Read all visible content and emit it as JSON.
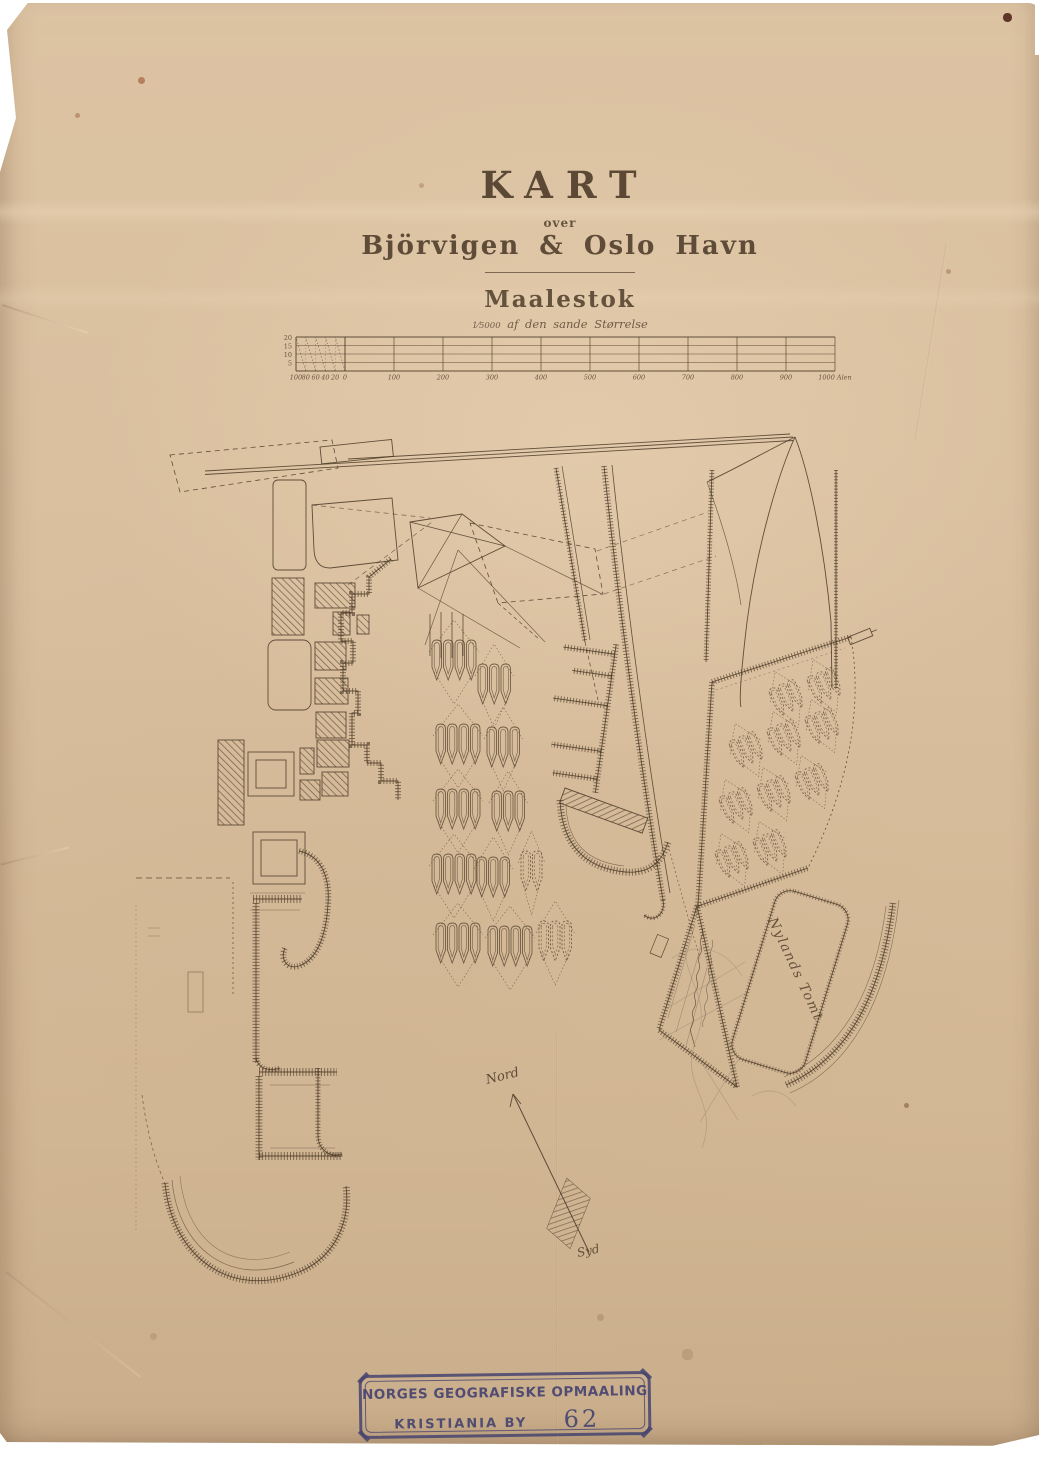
{
  "sheet": {
    "title": "KART",
    "title_sub": "over",
    "title_place": "Björvigen & Oslo Havn"
  },
  "scale": {
    "heading": "Maalestok",
    "fraction": "1⁄5000",
    "subtitle": "af den sande Størrelse",
    "unit": "Alen",
    "row_labels": [
      "20",
      "15",
      "10",
      "5"
    ],
    "left_tick_labels": [
      "100",
      "80",
      "60",
      "40",
      "20"
    ],
    "main_tick_labels": [
      "0",
      "100",
      "200",
      "300",
      "400",
      "500",
      "600",
      "700",
      "800",
      "900",
      "1000"
    ]
  },
  "map": {
    "compass_north": "Nord",
    "compass_south": "Syd",
    "dock_label": "Nylands Tomt"
  },
  "stamp": {
    "line1": "NORGES GEOGRAFISKE OPMAALING",
    "line2": "KRISTIANIA BY",
    "number": "62"
  },
  "colors": {
    "paper": "#d9c0a0",
    "ink": "#4a3826",
    "stamp_ink": "#474470",
    "pencil": "#9a8a74"
  }
}
